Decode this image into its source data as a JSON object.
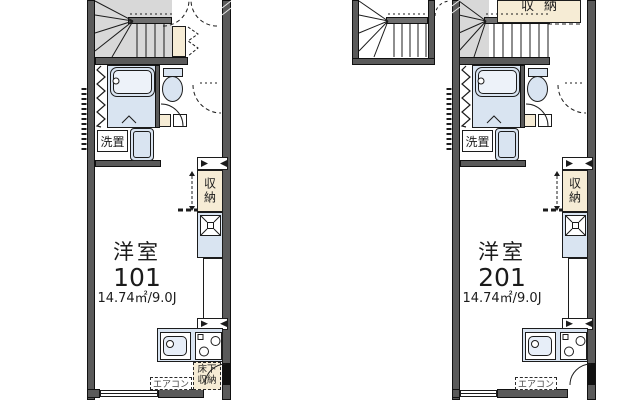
{
  "u101": {
    "room": "洋室",
    "num": "101",
    "area": "14.74㎡/9.0J",
    "washer": "洗置",
    "closet": "収納",
    "uf1": "床下",
    "uf2": "収納",
    "ac": "エアコン"
  },
  "u201": {
    "room": "洋室",
    "num": "201",
    "area": "14.74㎡/9.0J",
    "washer": "洗置",
    "closet": "収納",
    "top_storage": "収納",
    "ac": "エアコン"
  },
  "colors": {
    "wall": "#5a5a5a",
    "fixture_blue": "#d9e4f1",
    "storage_beige": "#f6ecd5",
    "stair_gray": "#d8d8d8",
    "line": "#1c1c1c"
  }
}
